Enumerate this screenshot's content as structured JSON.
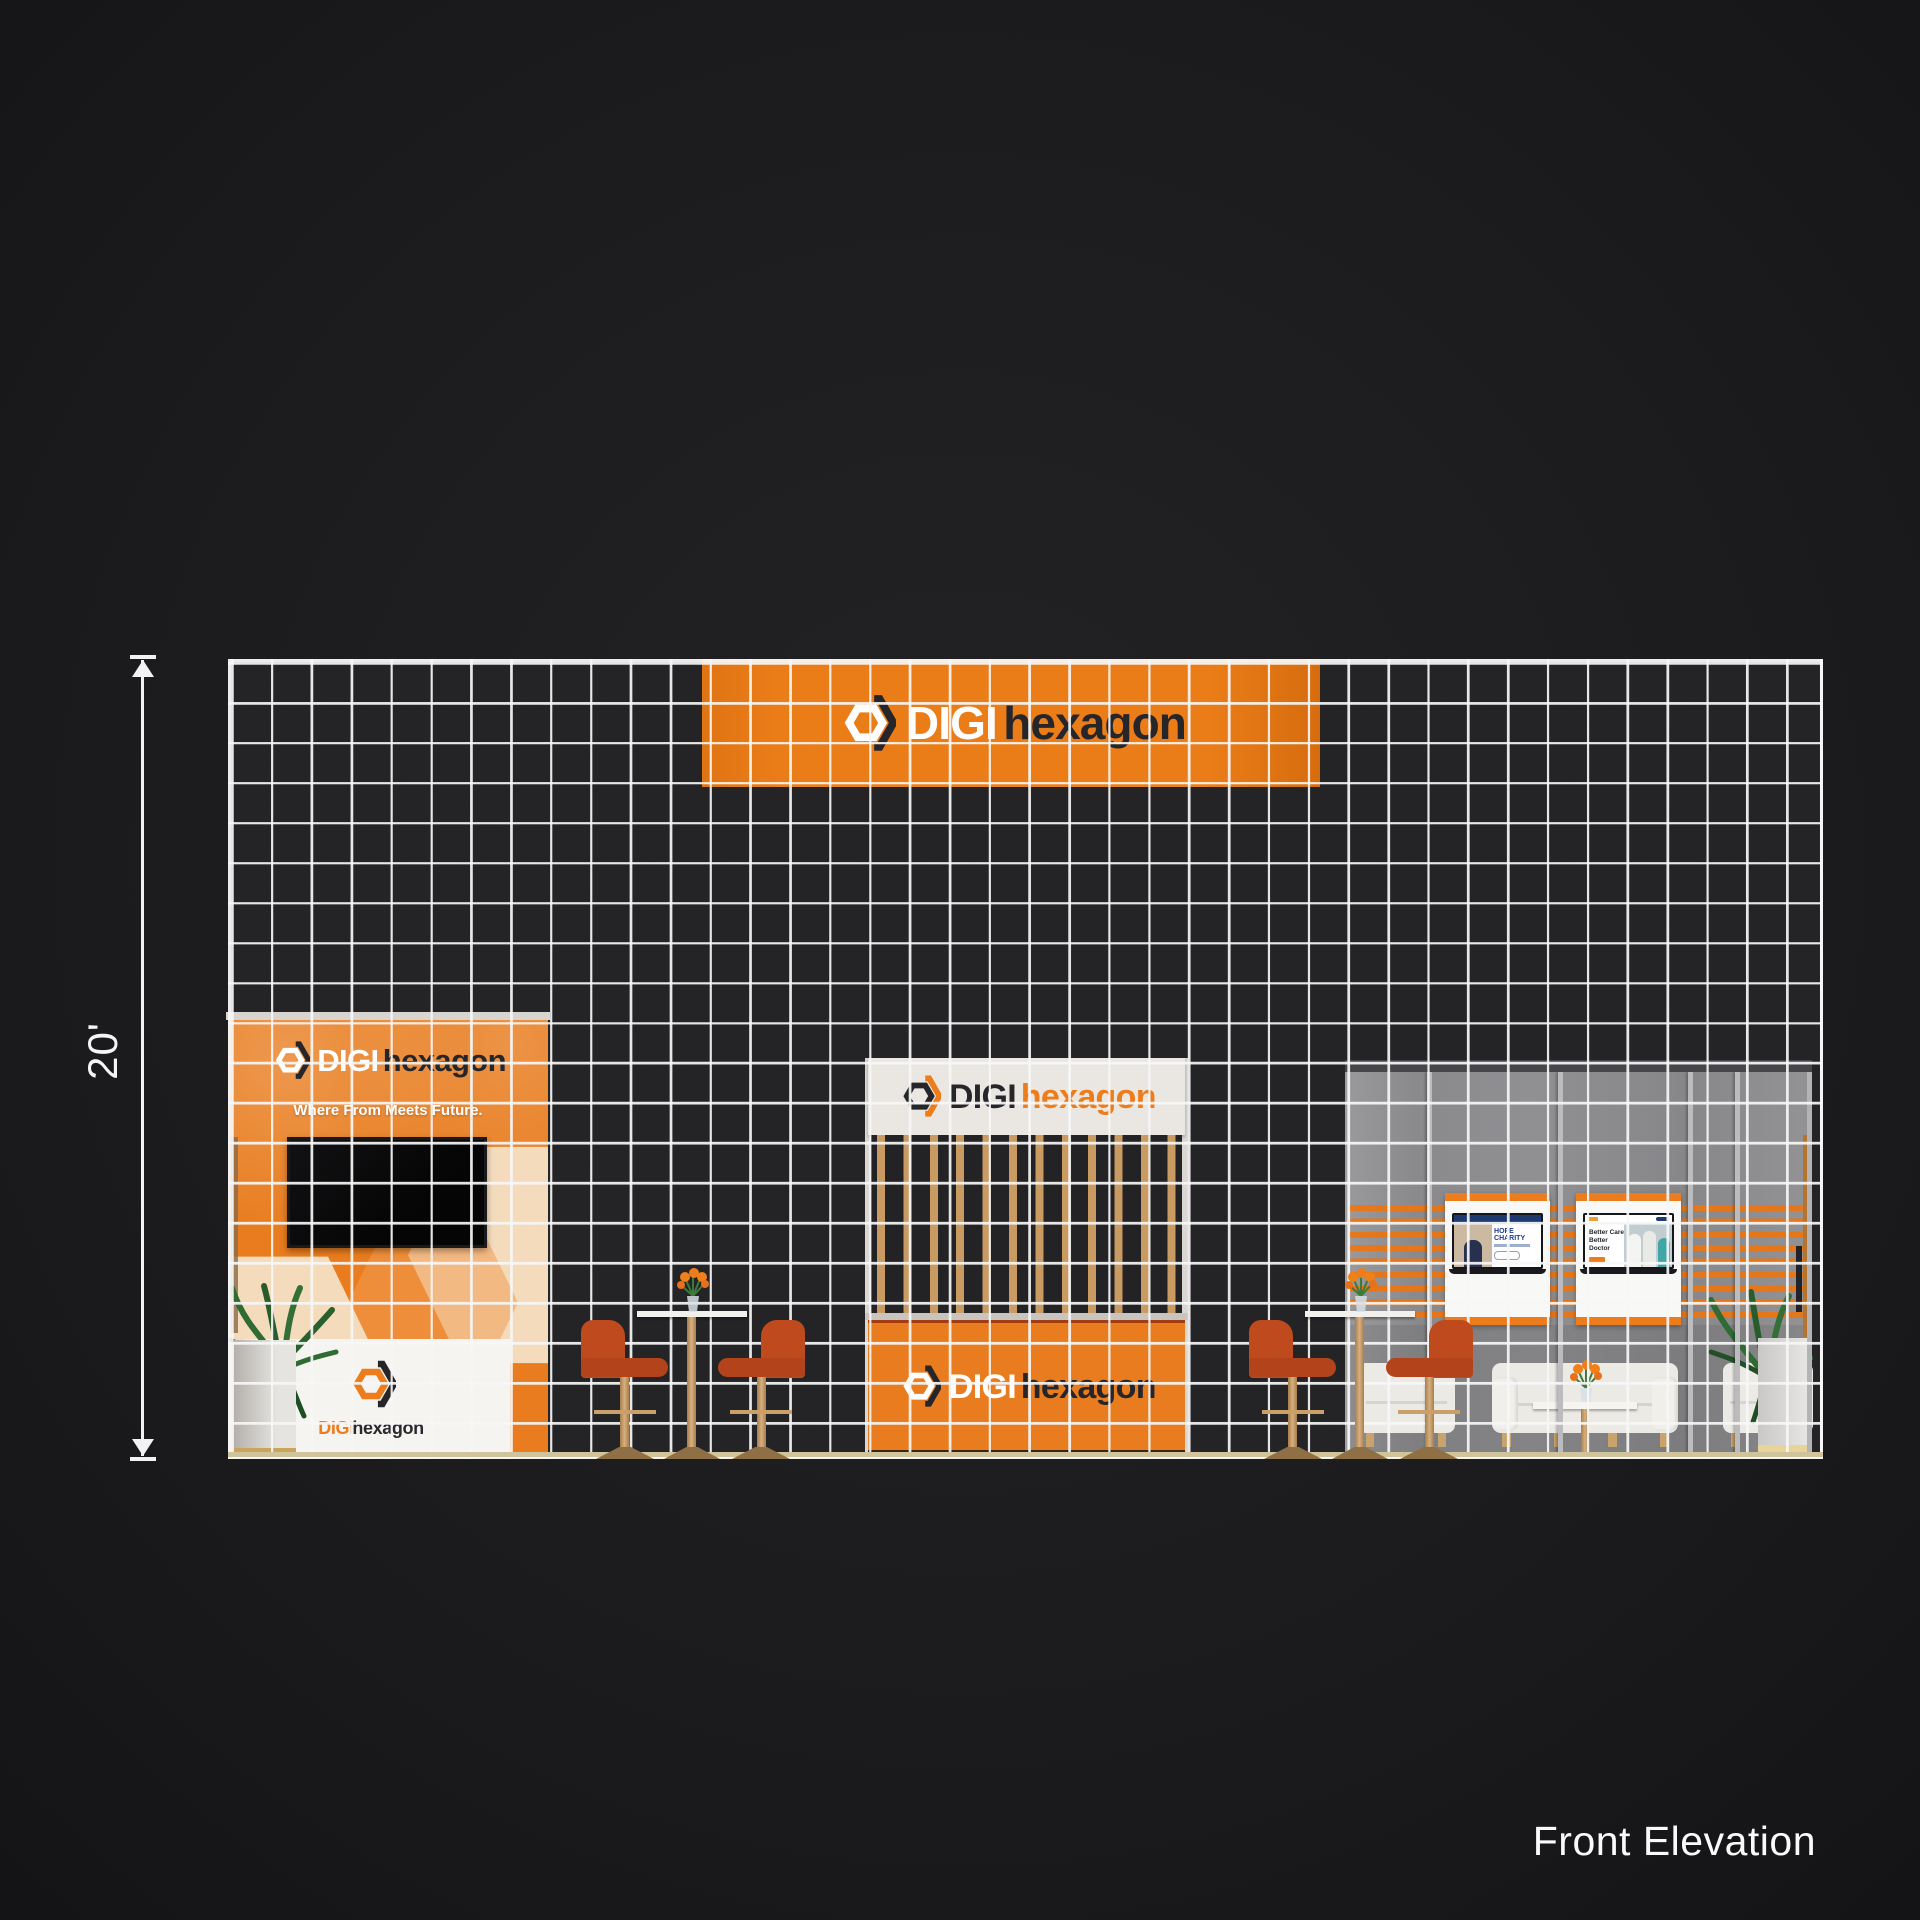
{
  "title": {
    "label": "Front Elevation"
  },
  "dimension": {
    "label": "20'",
    "feet": 20
  },
  "brand": {
    "digi": "DIGI",
    "hexagon": "hexagon",
    "tagline": "Where From Meets Future."
  },
  "posters": {
    "left": {
      "headline": "HOPE CHARITY"
    },
    "right": {
      "line1": "Better Care",
      "line2": "Better Doctor"
    }
  },
  "grid": {
    "columns": 40,
    "rows": 20,
    "cell_represents_feet": 1
  },
  "colors": {
    "brand_orange": "#ED7D1C",
    "brand_dark": "#26262A",
    "wood": "#C99A62",
    "glass_gray": "#8A8A8D",
    "stool_rust": "#BF4A1E",
    "counter_white": "#F6F4F0",
    "grid_line": "#F7F7F7",
    "background": "#1C1C1E"
  },
  "icons": {
    "logo_icon": "hexagon-icon",
    "dimension_marker": "arrow-icon",
    "plant": "plant-icon",
    "flowers": "flower-vase-icon"
  }
}
